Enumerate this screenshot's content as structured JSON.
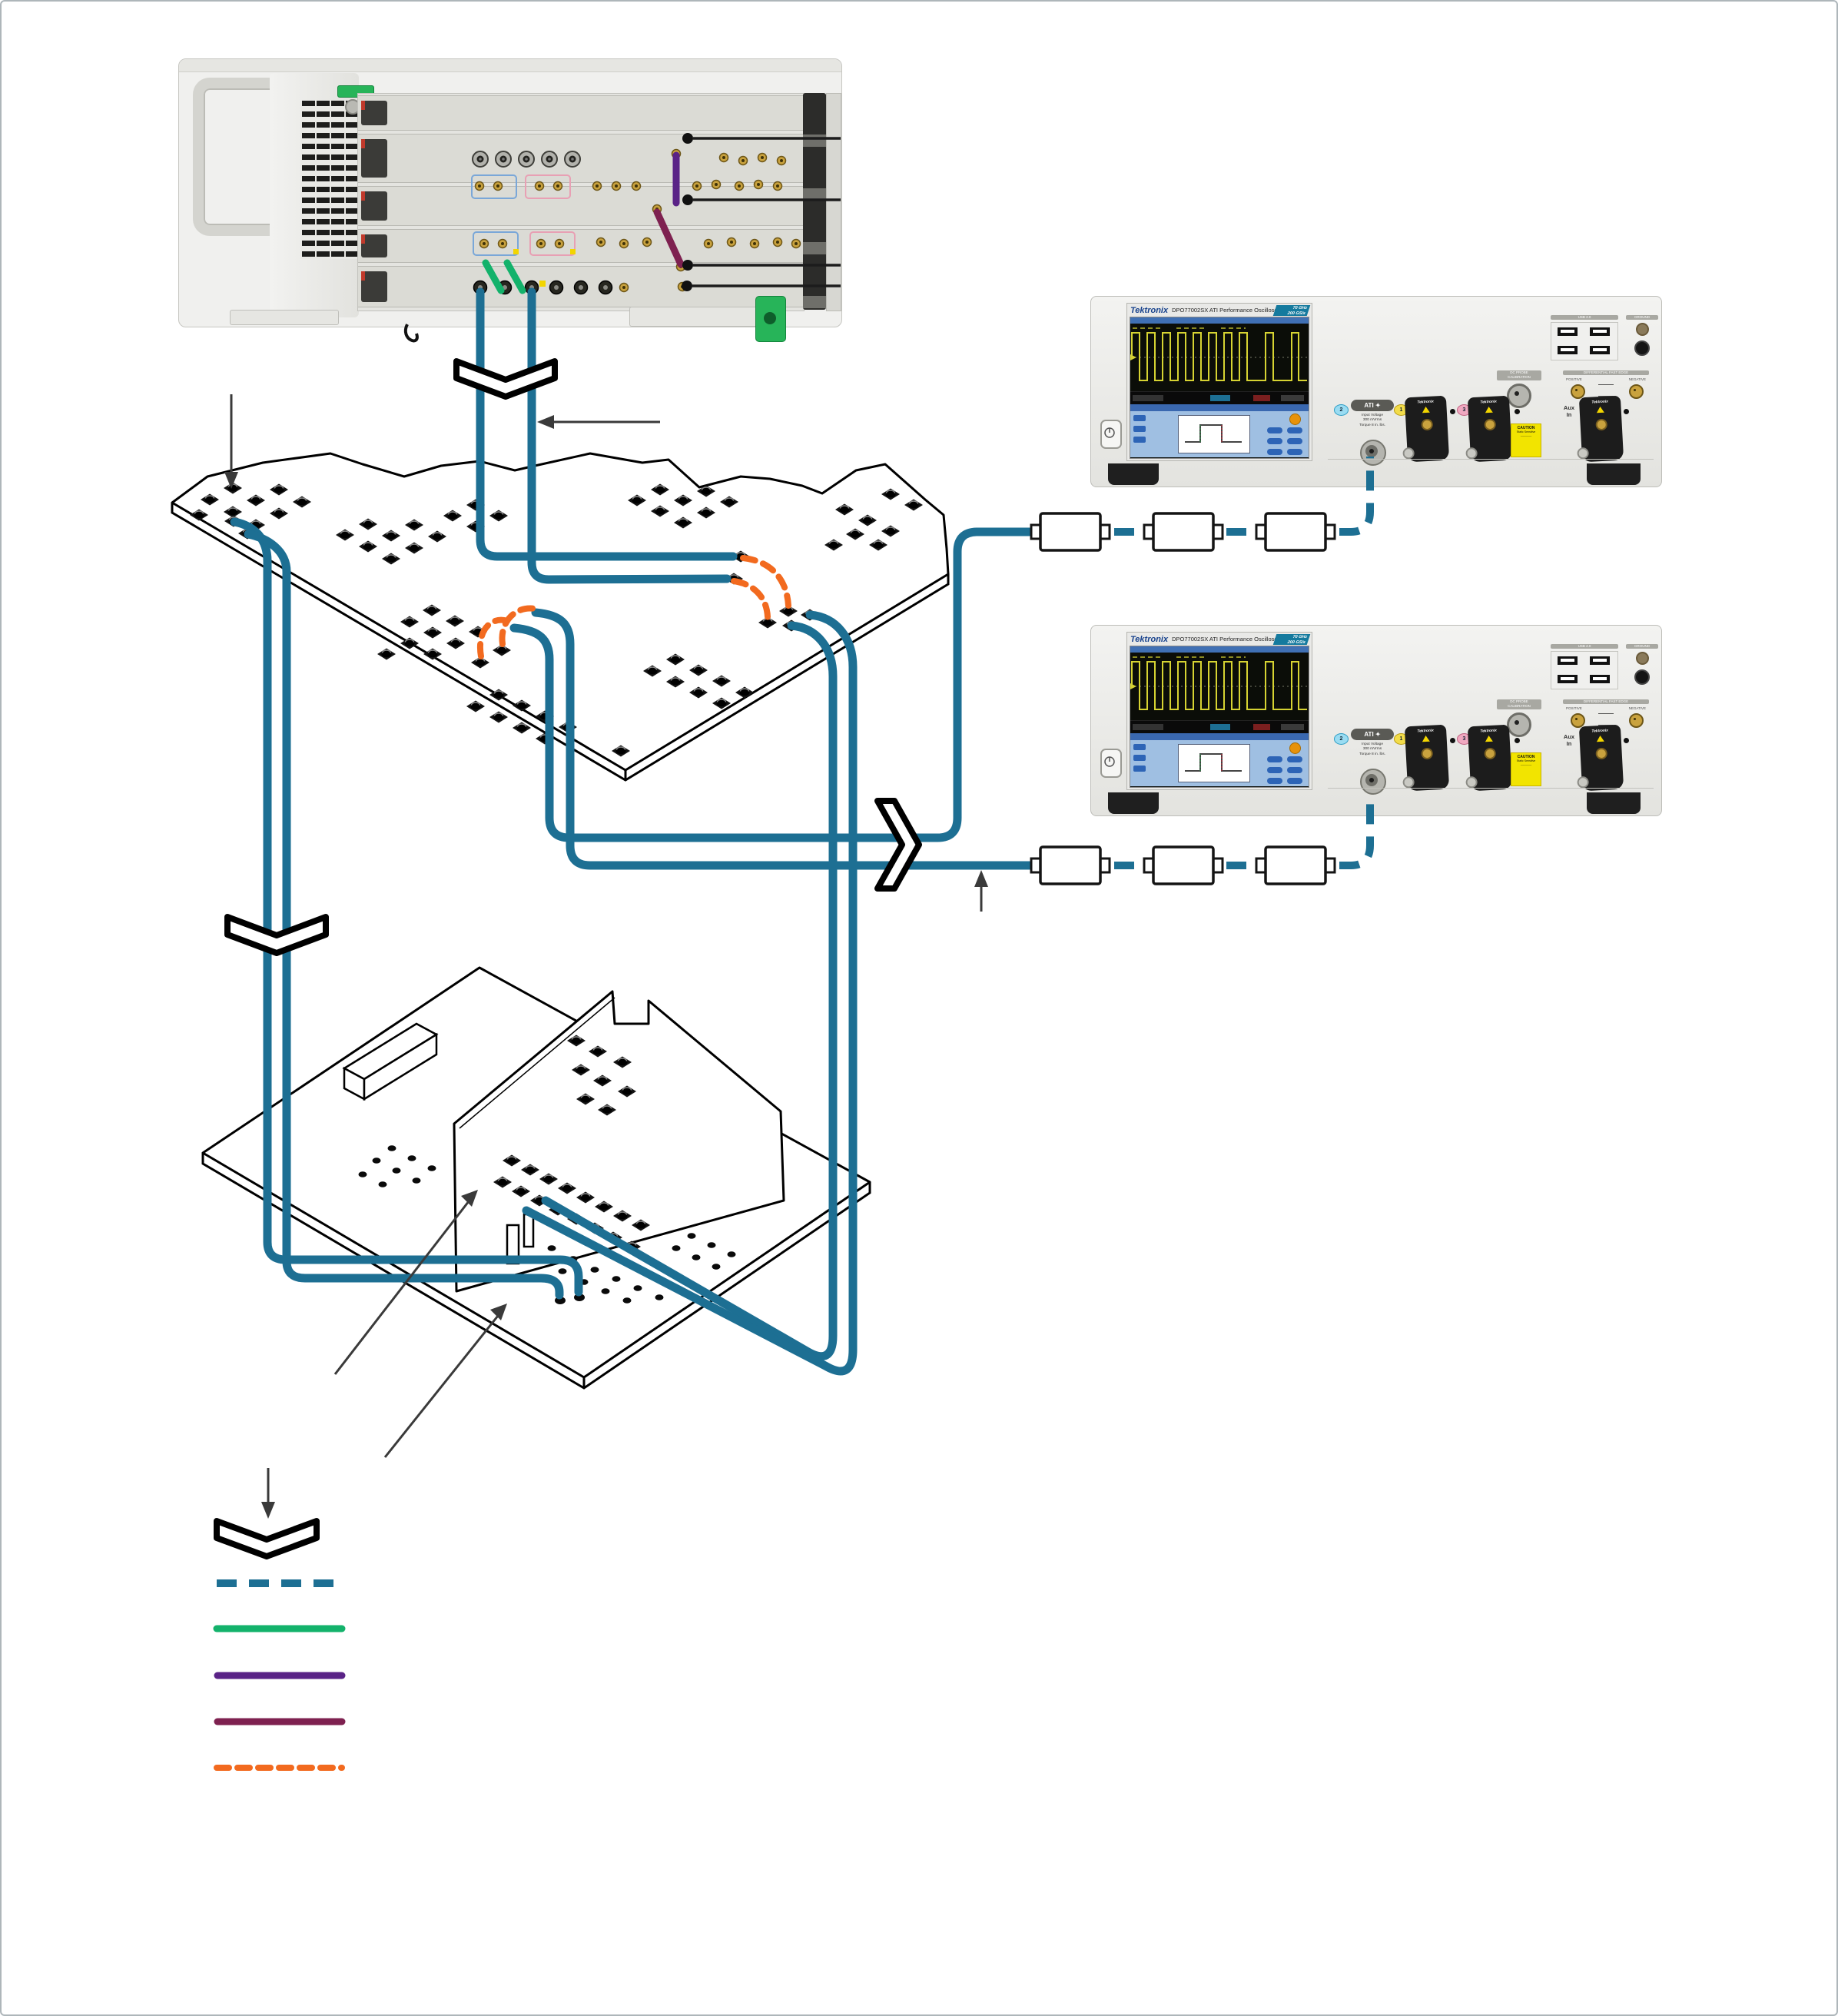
{
  "colors": {
    "cable-teal": "#1d6f93",
    "cable-green": "#13b26b",
    "cable-purple": "#5a2387",
    "cable-maroon": "#7e2150",
    "cable-orange": "#f26a1f",
    "scope-badge": "#157a9e",
    "chassis-green-accent": "#27b459",
    "waveform-yellow": "#d6d332"
  },
  "scope": {
    "brand": "Tektronix",
    "model": "DPO77002SX",
    "series_label": "ATI Performance Oscilloscope",
    "badge_line1": "70 GHz",
    "badge_line2": "200 GS/s",
    "ati_label": "ATI",
    "channel2": "2",
    "channel1": "1",
    "channel3": "3",
    "input_voltage_line1": "Input Voltage",
    "input_voltage_line2": "300 mVrms",
    "torque_line": "Torque 8 in. lbs.",
    "aux_line1": "Aux",
    "aux_line2": "In",
    "usb_label": "USB 2.0",
    "ground_label": "GROUND",
    "dc_probe_line1": "DC PROBE",
    "dc_probe_line2": "CALIBRATION",
    "diff_edge_label": "DIFFERENTIAL FAST EDGE",
    "positive_label": "POSITIVE",
    "negative_label": "NEGATIVE",
    "caution_title": "CAUTION",
    "caution_line": "Static Sensitive",
    "adapter_brand": "Tektronix"
  },
  "attenuator_chains": {
    "chains": 2,
    "boxes_per_chain": 3
  },
  "legend": {
    "items": [
      {
        "name": "cable-break-chevron",
        "style": "symbol",
        "color": "#000000"
      },
      {
        "name": "teal-dashed-cable",
        "style": "dashed",
        "color": "#1d6f93"
      },
      {
        "name": "green-cable",
        "style": "solid",
        "color": "#13b26b"
      },
      {
        "name": "purple-cable",
        "style": "solid",
        "color": "#5a2387"
      },
      {
        "name": "maroon-cable",
        "style": "solid",
        "color": "#7e2150"
      },
      {
        "name": "orange-dashed-jumper",
        "style": "dashed",
        "color": "#f26a1f"
      }
    ]
  }
}
